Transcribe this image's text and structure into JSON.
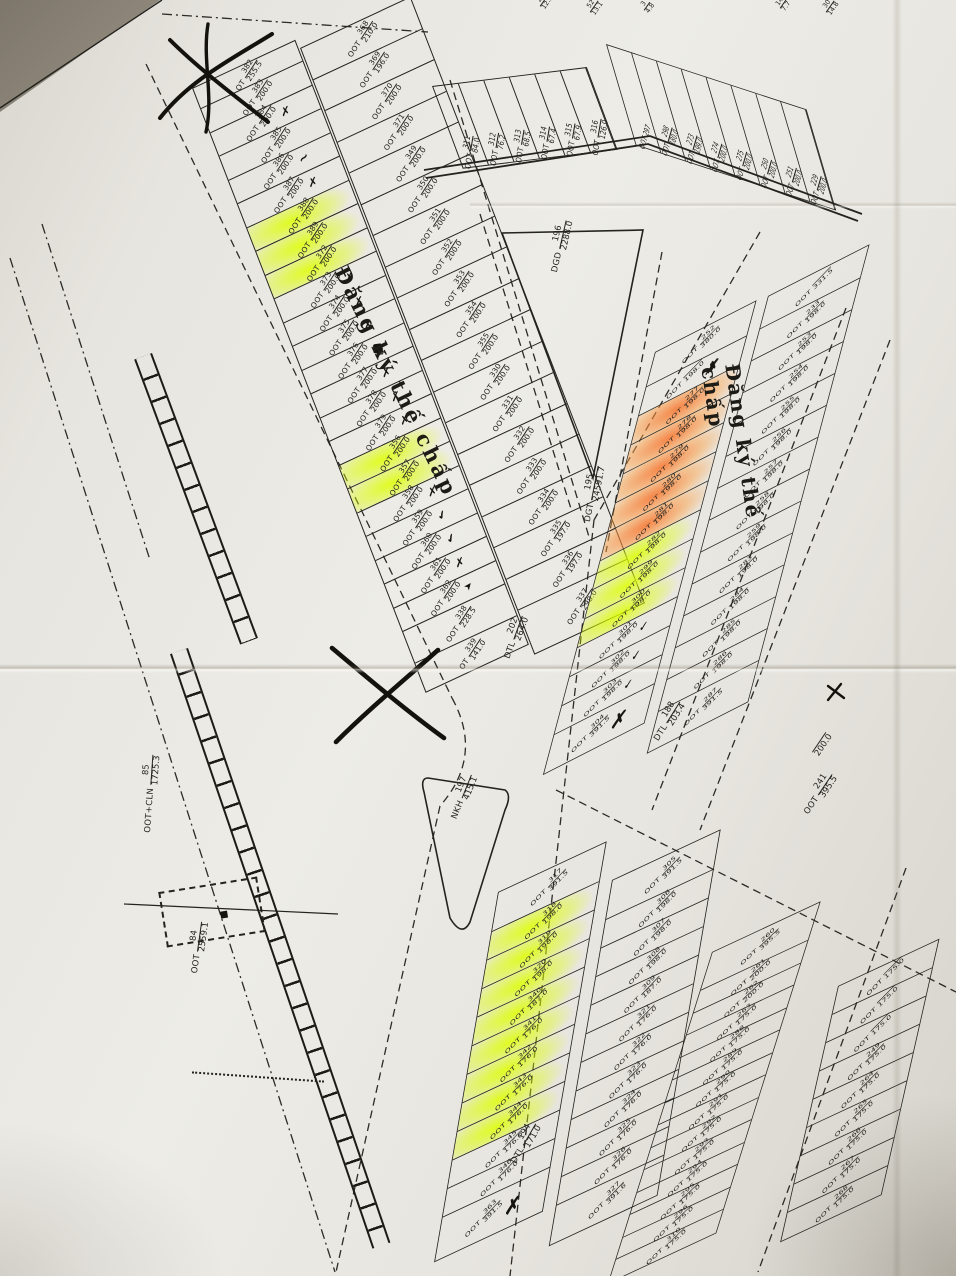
{
  "notes": {
    "mortgage": "Đăng ký thế chấp"
  },
  "area_labels": {
    "dgd": {
      "pfx": "DGD",
      "n": "196",
      "a": "2288.0"
    },
    "dgt": {
      "pfx": "DGT",
      "n": "195",
      "a": "24591.7"
    },
    "dtl202": {
      "pfx": "DTL",
      "n": "202",
      "a": "264.0"
    },
    "dtl188": {
      "pfx": "DTL",
      "n": "188",
      "a": "203.4"
    },
    "dtl194": {
      "pfx": "DTL",
      "n": "194",
      "a": "171.0"
    },
    "nkh": {
      "pfx": "NKH",
      "n": "197",
      "a": "415.1"
    },
    "oot84": {
      "pfx": "OOT",
      "n": "84",
      "a": "2559.1"
    },
    "ootcln85": {
      "pfx": "OOT+CLN",
      "n": "85",
      "a": "1725.3"
    },
    "oot241": {
      "pfx": "OOT",
      "n": "241",
      "a": "395.5"
    },
    "edge200": {
      "pfx": "",
      "n": "",
      "a": "200.0"
    }
  },
  "tiny_plots": [
    {
      "n": "25",
      "a": "12.5"
    },
    {
      "n": "52",
      "a": "13.1"
    },
    {
      "n": "3",
      "a": "4.8"
    },
    {
      "n": "14",
      "a": "7.7"
    },
    {
      "n": "30",
      "a": "14.8"
    }
  ],
  "columns": {
    "a_left": [
      {
        "p": "OT",
        "n": "382",
        "a": "255.5"
      },
      {
        "n": "383",
        "a": "200.0"
      },
      {
        "n": "384",
        "a": "200.0",
        "mk": "x"
      },
      {
        "n": "385",
        "a": "200.0"
      },
      {
        "n": "386",
        "a": "200.0",
        "mk": "squiggle"
      },
      {
        "n": "387",
        "a": "200.0",
        "mk": "x"
      },
      {
        "n": "388",
        "a": "200.0",
        "hl": "y"
      },
      {
        "n": "389",
        "a": "200.0",
        "hl": "y"
      },
      {
        "n": "372",
        "a": "200.0",
        "hl": "y"
      },
      {
        "n": "373",
        "a": "200.0",
        "mk": "x"
      },
      {
        "n": "374",
        "a": "200.0",
        "mk": "x"
      },
      {
        "n": "375",
        "a": "200.0",
        "mk": "x"
      },
      {
        "n": "376",
        "a": "200.0",
        "mk": "blot"
      },
      {
        "n": "377",
        "a": "200.0",
        "mk": "x"
      },
      {
        "n": "378",
        "a": "200.0",
        "mk": "x"
      },
      {
        "n": "379",
        "a": "200.0",
        "mk": "x"
      },
      {
        "n": "356",
        "a": "200.0",
        "hl": "y"
      },
      {
        "n": "357",
        "a": "200.0",
        "hl": "y"
      },
      {
        "n": "358",
        "a": "200.0",
        "mk": "x"
      },
      {
        "n": "359",
        "a": "200.0",
        "mk": "check"
      },
      {
        "n": "360",
        "a": "200.0",
        "mk": "check"
      },
      {
        "n": "361",
        "a": "200.0",
        "mk": "x"
      },
      {
        "n": "362",
        "a": "200.0",
        "mk": "arrow"
      },
      {
        "n": "338",
        "a": "228.5"
      },
      {
        "p": "OT",
        "n": "339",
        "a": "141.0"
      }
    ],
    "a_right": [
      {
        "n": "368",
        "a": "210.0"
      },
      {
        "n": "369",
        "a": "196.0"
      },
      {
        "n": "370",
        "a": "200.0"
      },
      {
        "n": "371",
        "a": "200.0"
      },
      {
        "n": "349",
        "a": "200.0"
      },
      {
        "n": "350",
        "a": "200.0"
      },
      {
        "n": "351",
        "a": "200.0"
      },
      {
        "n": "352",
        "a": "200.0"
      },
      {
        "n": "353",
        "a": "200.0"
      },
      {
        "n": "354",
        "a": "200.0"
      },
      {
        "n": "355",
        "a": "200.0"
      },
      {
        "n": "330",
        "a": "200.0"
      },
      {
        "n": "331",
        "a": "200.0"
      },
      {
        "n": "332",
        "a": "200.0"
      },
      {
        "n": "333",
        "a": "200.0"
      },
      {
        "n": "334",
        "a": "200.0"
      },
      {
        "n": "335",
        "a": "197.0"
      },
      {
        "n": "336",
        "a": "197.0"
      },
      {
        "n": "337",
        "a": "298.0"
      }
    ],
    "b_left": [
      {
        "n": "252",
        "a": "380.0"
      },
      {
        "n": "",
        "a": "198.0",
        "mk": "scribble"
      },
      {
        "n": "277",
        "a": "198.0",
        "hl": "o"
      },
      {
        "n": "278",
        "a": "198.0",
        "hl": "o"
      },
      {
        "n": "279",
        "a": "198.0",
        "hl": "o"
      },
      {
        "n": "280",
        "a": "198.0",
        "hl": "o"
      },
      {
        "n": "281",
        "a": "198.0",
        "hl": "o"
      },
      {
        "n": "282",
        "a": "198.0",
        "hl": "y"
      },
      {
        "n": "299",
        "a": "198.0",
        "hl": "y"
      },
      {
        "n": "300",
        "a": "198.0",
        "hl": "y"
      },
      {
        "n": "301",
        "a": "198.0",
        "mk": "check"
      },
      {
        "n": "302",
        "a": "198.0",
        "mk": "check"
      },
      {
        "n": "303",
        "a": "198.0",
        "mk": "check"
      },
      {
        "n": "304",
        "a": "391.5",
        "mk": "bigx"
      }
    ],
    "b_right": [
      {
        "n": "",
        "a": "331.5"
      },
      {
        "n": "233",
        "a": "198.0"
      },
      {
        "n": "253",
        "a": "198.0"
      },
      {
        "n": "254",
        "a": "198.0"
      },
      {
        "n": "255",
        "a": "198.0"
      },
      {
        "n": "256",
        "a": "198.0"
      },
      {
        "n": "257",
        "a": "198.0"
      },
      {
        "n": "258",
        "a": "198.0"
      },
      {
        "n": "259",
        "a": "198.0"
      },
      {
        "n": "283",
        "a": "198.0"
      },
      {
        "n": "284",
        "a": "198.0"
      },
      {
        "n": "285",
        "a": "198.0"
      },
      {
        "n": "286",
        "a": "198.0"
      },
      {
        "n": "287",
        "a": "391.5"
      }
    ],
    "c_left": [
      {
        "n": "317",
        "a": "391.5"
      },
      {
        "n": "318",
        "a": "198.0",
        "hl": "y"
      },
      {
        "n": "319",
        "a": "198.0",
        "hl": "y"
      },
      {
        "n": "320",
        "a": "198.0",
        "hl": "y"
      },
      {
        "n": "340",
        "a": "187.0",
        "hl": "y"
      },
      {
        "n": "341",
        "a": "176.0",
        "hl": "y"
      },
      {
        "n": "342",
        "a": "176.0",
        "hl": "y"
      },
      {
        "n": "343",
        "a": "176.0",
        "hl": "y"
      },
      {
        "n": "344",
        "a": "176.0",
        "hl": "y"
      },
      {
        "n": "345",
        "a": "176.0"
      },
      {
        "n": "346",
        "a": "176.0"
      },
      {
        "n": "363",
        "a": "391.5",
        "mk": "bigx"
      }
    ],
    "c_right": [
      {
        "n": "305",
        "a": "391.5"
      },
      {
        "n": "306",
        "a": "198.0"
      },
      {
        "n": "307",
        "a": "198.0"
      },
      {
        "n": "308",
        "a": "198.0"
      },
      {
        "n": "309",
        "a": "187.0"
      },
      {
        "n": "321",
        "a": "176.0"
      },
      {
        "n": "322",
        "a": "176.0"
      },
      {
        "n": "323",
        "a": "176.0"
      },
      {
        "n": "324",
        "a": "176.0"
      },
      {
        "n": "325",
        "a": "176.0"
      },
      {
        "n": "326",
        "a": "176.0"
      },
      {
        "n": "327",
        "a": "391.6"
      }
    ],
    "d_left": [
      {
        "n": "260",
        "a": "395.5"
      },
      {
        "n": "261",
        "a": "200.0"
      },
      {
        "n": "262",
        "a": "200.0"
      },
      {
        "n": "263",
        "a": "175.0"
      },
      {
        "n": "288",
        "a": "175.0"
      },
      {
        "n": "289",
        "a": "175.0"
      },
      {
        "n": "290",
        "a": "175.0"
      },
      {
        "n": "291",
        "a": "175.0"
      },
      {
        "n": "292",
        "a": "175.0"
      },
      {
        "n": "293",
        "a": "175.0"
      },
      {
        "n": "294",
        "a": "175.0"
      },
      {
        "n": "295",
        "a": "175.0"
      },
      {
        "n": "296",
        "a": "175.0"
      },
      {
        "n": "310",
        "a": "175.0"
      }
    ],
    "d_right": [
      {
        "n": "",
        "a": "175.0"
      },
      {
        "n": "",
        "a": "175.0"
      },
      {
        "n": "",
        "a": "175.0"
      },
      {
        "n": "249",
        "a": "175.0"
      },
      {
        "n": "264",
        "a": "175.0"
      },
      {
        "n": "265",
        "a": "175.0"
      },
      {
        "n": "266",
        "a": "175.0"
      },
      {
        "n": "267",
        "a": "175.0"
      },
      {
        "n": "268",
        "a": "175.0"
      }
    ],
    "top_left": [
      {
        "n": "311",
        "a": "84.0"
      },
      {
        "n": "312",
        "a": "76.2"
      },
      {
        "n": "313",
        "a": "68.5"
      },
      {
        "n": "314",
        "a": "67.4"
      },
      {
        "n": "315",
        "a": "67.9"
      },
      {
        "n": "316",
        "a": "126.0"
      }
    ],
    "top_right": [
      {
        "n": "297",
        "a": ""
      },
      {
        "n": "298",
        "a": "180.0"
      },
      {
        "n": "273",
        "a": "199.0"
      },
      {
        "n": "274",
        "a": "200.0"
      },
      {
        "n": "275",
        "a": "200.0"
      },
      {
        "n": "250",
        "a": "200.0"
      },
      {
        "n": "251",
        "a": "200.0"
      },
      {
        "n": "229",
        "a": "200.0"
      }
    ]
  }
}
